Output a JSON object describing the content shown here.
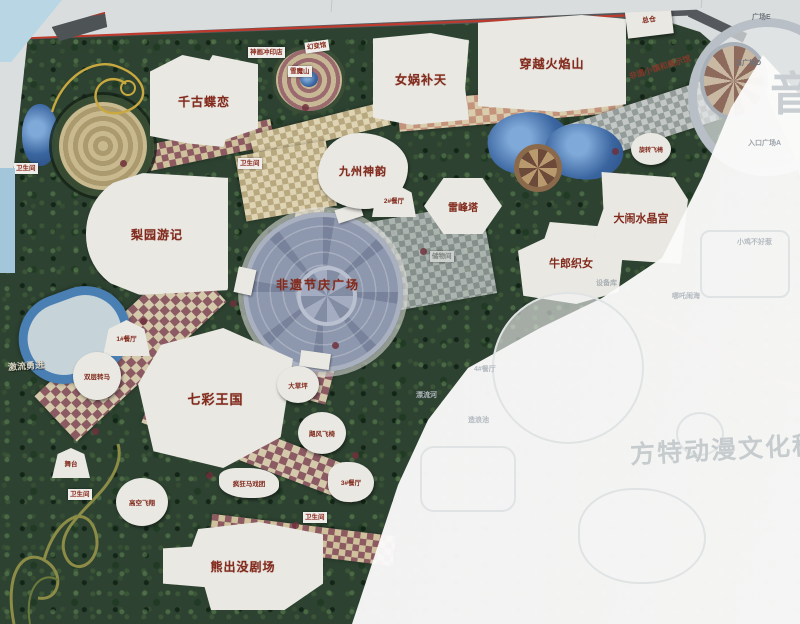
{
  "labels": {
    "qiangudielian": "千古蝶恋",
    "nuwabutian": "女娲补天",
    "chuanyuehuoyanshan": "穿越火焰山",
    "jiuzhoushenyun": "九州神韵",
    "liyuanyouji": "梨园游记",
    "leifengta": "雷峰塔",
    "niulangzhinv": "牛郎织女",
    "danaoshuijinggong": "大闹水晶宫",
    "feiyijieqing": "非遗节庆广场",
    "qicaiwangguo": "七彩王国",
    "xiongchumojuchang": "熊出没剧场",
    "zongcang": "总仓",
    "jiliuyongjin": "激流勇进",
    "canting1": "1#餐厅",
    "canting2": "2#餐厅",
    "canting3": "3#餐厅",
    "canting4": "4#餐厅",
    "shuangcengzhuanma": "双层转马",
    "wutai": "舞台",
    "gaokongfeixiang": "高空飞翔",
    "fengkuangmaxituan": "疯狂马戏团",
    "jufengfeiyi": "飓风飞椅",
    "xuanzhuanfeiyi": "旋转飞椅",
    "dacaoping": "大草坪",
    "weishengjian": "卫生间",
    "chuwujian": "储物间",
    "shebeiku": "设备库",
    "shenhuachongyindian": "神画冲印店",
    "huanbianguan": "幻变馆",
    "xuemoshan": "雪魔山",
    "feiyixiaozhen": "非遗小镇和展示馆",
    "guangchangE": "广场E",
    "kouguangchangD": "口广场D",
    "rukouguangchangA": "入口广场A",
    "xiaojibuhaore": "小鸡不好惹",
    "nezhanaohai": "哪吒闹海",
    "piaoliuhe": "漂流河",
    "zaolangchi": "造浪池",
    "watermark_fantawild": "方特动漫文化科技",
    "watermark_yin": "音"
  }
}
